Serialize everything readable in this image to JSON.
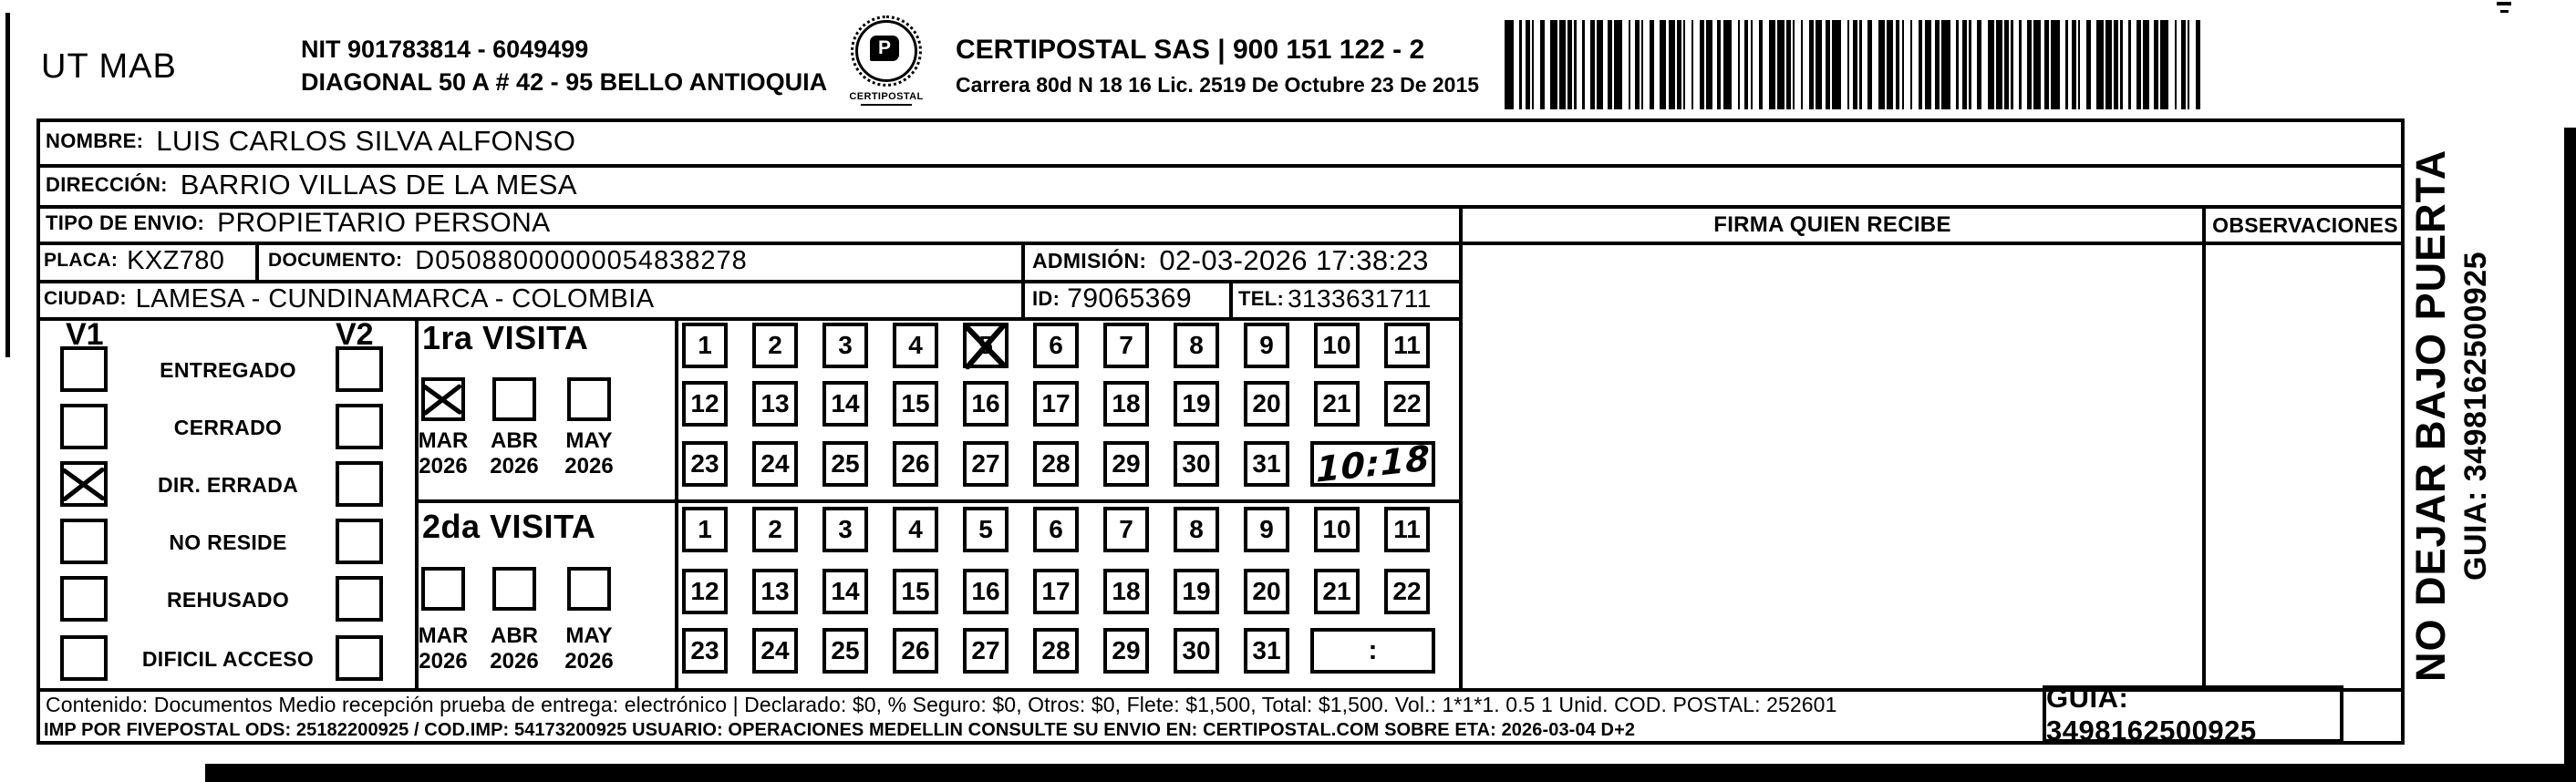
{
  "header": {
    "sender_code": "UT MAB",
    "nit_line1": "NIT 901783814 - 6049499",
    "nit_line2": "DIAGONAL 50 A # 42 - 95  BELLO  ANTIOQUIA",
    "logo_text": "CERTIPOSTAL",
    "company_line1": "CERTIPOSTAL SAS | 900 151 122 - 2",
    "company_line2": "Carrera 80d N 18 16  Lic. 2519 De Octubre 23 De 2015",
    "barcode_icon": "code128-barcode"
  },
  "shipment": {
    "nombre_label": "NOMBRE:",
    "nombre": "LUIS CARLOS SILVA ALFONSO",
    "direccion_label": "DIRECCIÓN:",
    "direccion": "BARRIO VILLAS DE LA MESA",
    "tipo_envio_label": "TIPO DE ENVIO:",
    "tipo_envio": "PROPIETARIO PERSONA",
    "placa_label": "PLACA:",
    "placa": "KXZ780",
    "documento_label": "DOCUMENTO:",
    "documento": "D05088000000054838278",
    "admision_label": "ADMISIÓN:",
    "admision": "02-03-2026 17:38:23",
    "ciudad_label": "CIUDAD:",
    "ciudad": "LAMESA - CUNDINAMARCA - COLOMBIA",
    "id_label": "ID:",
    "id_value": "79065369",
    "tel_label": "TEL:",
    "tel": "3133631711"
  },
  "status_panel": {
    "v1_label": "V1",
    "v2_label": "V2",
    "options": [
      {
        "id": "entregado",
        "label": "ENTREGADO",
        "v1_checked": false,
        "v2_checked": false
      },
      {
        "id": "cerrado",
        "label": "CERRADO",
        "v1_checked": false,
        "v2_checked": false
      },
      {
        "id": "dir-errada",
        "label": "DIR. ERRADA",
        "v1_checked": true,
        "v2_checked": false
      },
      {
        "id": "no-reside",
        "label": "NO RESIDE",
        "v1_checked": false,
        "v2_checked": false
      },
      {
        "id": "rehusado",
        "label": "REHUSADO",
        "v1_checked": false,
        "v2_checked": false
      },
      {
        "id": "dificil-acceso",
        "label": "DIFICIL ACCESO",
        "v1_checked": false,
        "v2_checked": false
      }
    ]
  },
  "visits": {
    "first": {
      "title": "1ra VISITA",
      "months": [
        {
          "label": "MAR",
          "year": "2026",
          "checked": true
        },
        {
          "label": "ABR",
          "year": "2026",
          "checked": false
        },
        {
          "label": "MAY",
          "year": "2026",
          "checked": false
        }
      ],
      "days": [
        1,
        2,
        3,
        4,
        5,
        6,
        7,
        8,
        9,
        10,
        11,
        12,
        13,
        14,
        15,
        16,
        17,
        18,
        19,
        20,
        21,
        22,
        23,
        24,
        25,
        26,
        27,
        28,
        29,
        30,
        31
      ],
      "crossed_day": 5,
      "time_note": "10:18",
      "time_handwritten": true
    },
    "second": {
      "title": "2da VISITA",
      "months": [
        {
          "label": "MAR",
          "year": "2026",
          "checked": false
        },
        {
          "label": "ABR",
          "year": "2026",
          "checked": false
        },
        {
          "label": "MAY",
          "year": "2026",
          "checked": false
        }
      ],
      "days": [
        1,
        2,
        3,
        4,
        5,
        6,
        7,
        8,
        9,
        10,
        11,
        12,
        13,
        14,
        15,
        16,
        17,
        18,
        19,
        20,
        21,
        22,
        23,
        24,
        25,
        26,
        27,
        28,
        29,
        30,
        31
      ],
      "crossed_day": null,
      "time_note": ":",
      "time_handwritten": false
    }
  },
  "table_headers": {
    "firma": "FIRMA QUIEN RECIBE",
    "observaciones": "OBSERVACIONES"
  },
  "side_note": {
    "line1": "NO DEJAR BAJO PUERTA",
    "line2": "GUIA: 3498162500925"
  },
  "footer": {
    "contenido_line": "Contenido: Documentos Medio recepción prueba de entrega: electrónico | Declarado: $0, % Seguro: $0, Otros: $0, Flete: $1,500, Total: $1,500. Vol.: 1*1*1. 0.5  1 Unid. COD. POSTAL: 252601",
    "imp_line": "IMP POR FIVEPOSTAL ODS: 25182200925 / COD.IMP: 54173200925 USUARIO: OPERACIONES MEDELLIN CONSULTE SU ENVIO EN: CERTIPOSTAL.COM SOBRE ETA: 2026-03-04 D+2",
    "guia_label": "GUIA: 3498162500925"
  },
  "colors": {
    "ink": "#000000",
    "paper": "#ffffff"
  }
}
